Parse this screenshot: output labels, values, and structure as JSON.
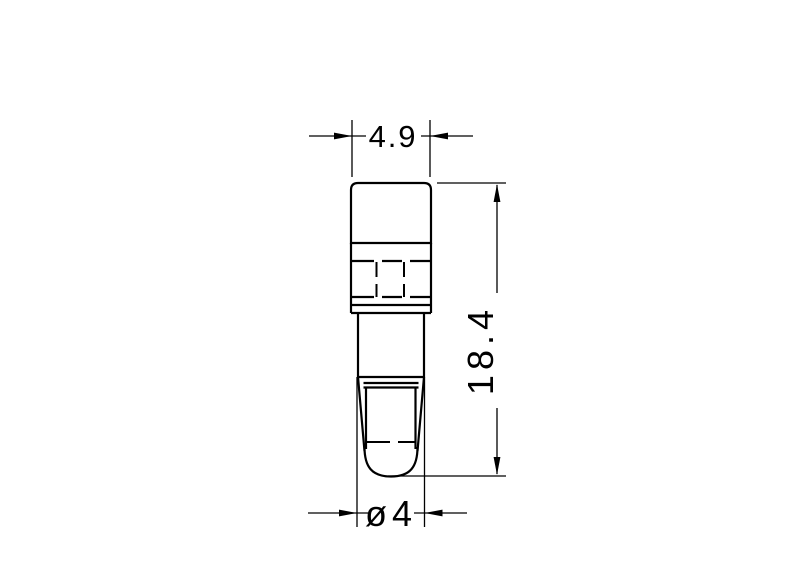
{
  "drawing": {
    "background_color": "#ffffff",
    "line_color": "#000000",
    "view": "led-holder-front-view",
    "dimensions": {
      "width": {
        "value": "4.9"
      },
      "height": {
        "value": "18.4"
      },
      "diameter": {
        "value": "ø4"
      }
    }
  }
}
